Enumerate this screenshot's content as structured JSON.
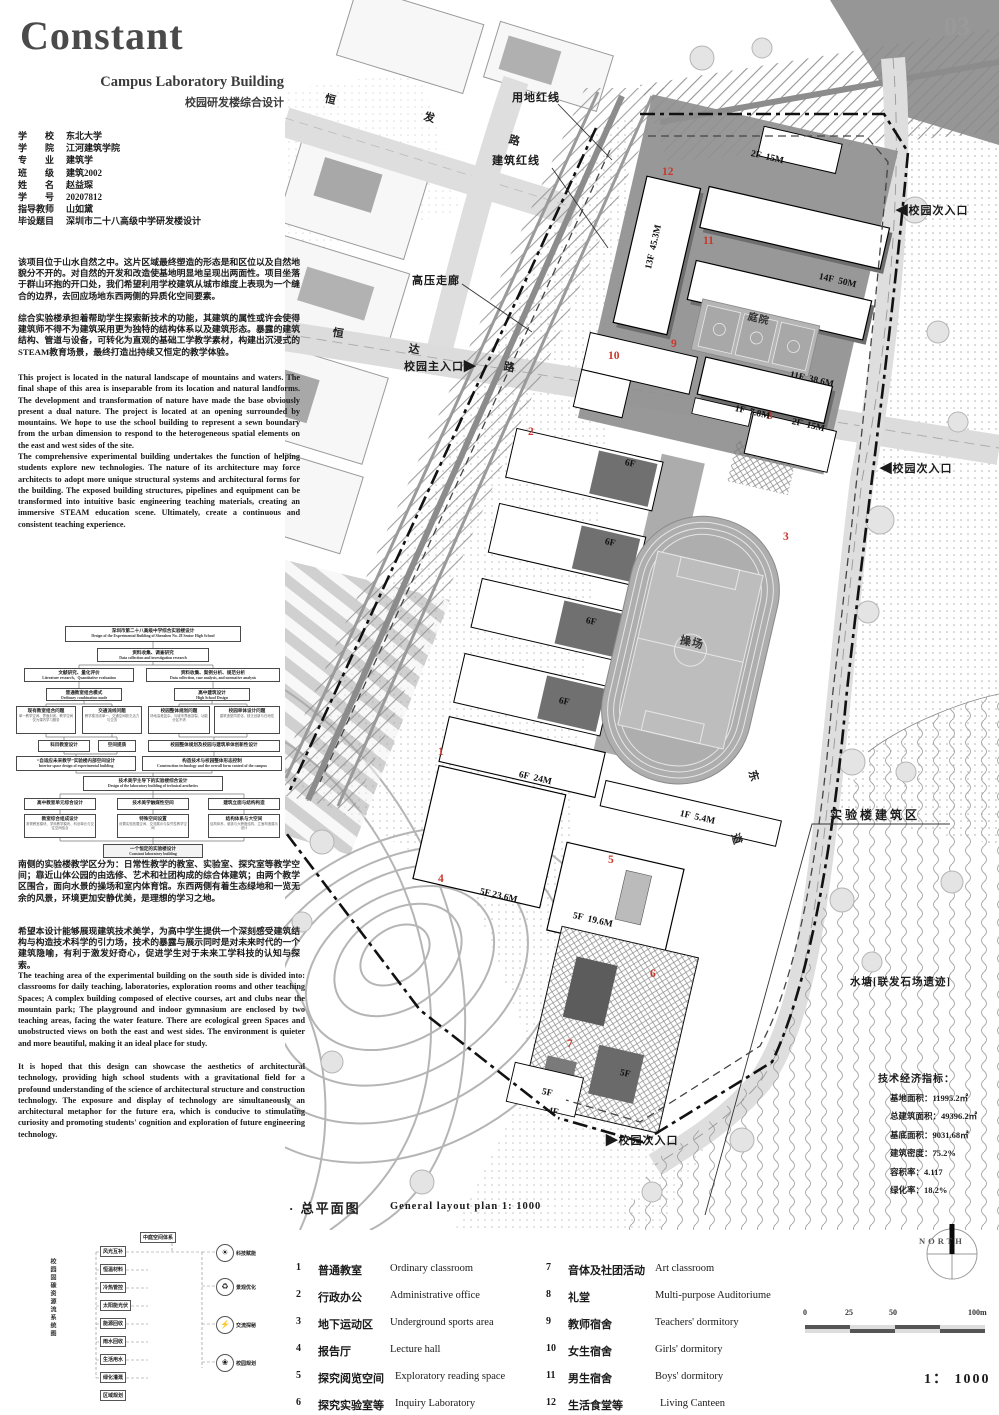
{
  "page": {
    "number": "03"
  },
  "header": {
    "title": "Constant",
    "subtitle_en": "Campus Laboratory Building",
    "subtitle_zh": "校园研发楼综合设计"
  },
  "info": {
    "rows": [
      {
        "label": "学　　校",
        "value": "东北大学"
      },
      {
        "label": "学　　院",
        "value": "江河建筑学院"
      },
      {
        "label": "专　　业",
        "value": "建筑学"
      },
      {
        "label": "班　　级",
        "value": "建筑2002"
      },
      {
        "label": "姓　　名",
        "value": "赵益琛"
      },
      {
        "label": "学　　号",
        "value": "20207812"
      },
      {
        "label": "指导教师",
        "value": "山如黛"
      },
      {
        "label": "毕设题目",
        "value": "深圳市二十八高级中学研发楼设计"
      }
    ]
  },
  "paras": {
    "zh1a": "该项目位于山水自然之中。这片区域最终塑造的形态是和区位以及自然地貌分不开的。对自然的开发和改造使基地明显地呈现出两面性。项目坐落于群山环抱的开口处，我们希望利用学校建筑从城市维度上表现为一个缝合的边界，去回应场地东西两侧的异质化空间要素。",
    "zh1b": "综合实验楼承担着帮助学生探索新技术的功能，其建筑的属性或许会使得建筑师不得不为建筑采用更为独特的结构体系以及建筑形态。暴露的建筑结构、管道与设备，可转化为直观的基础工学教学素材，构建出沉浸式的STEAM教育场景，最终打造出持续又恒定的教学体验。",
    "en1a": "This project is located in the natural landscape of mountains and waters. The final shape of this area is inseparable from its location and natural landforms. The development and transformation of nature have made the base obviously present a dual nature. The project is located at an opening surrounded by mountains. We hope to use the school building to represent a sewn boundary from the urban dimension to respond to the heterogeneous spatial elements on the east and west sides of the site.",
    "en1b": "The comprehensive experimental building undertakes the function of helping students explore new technologies. The nature of its architecture may force architects to adopt more unique structural systems and architectural forms for the building. The exposed building structures, pipelines and equipment can be transformed into intuitive basic engineering teaching materials, creating an immersive STEAM education scene. Ultimately, create a continuous and consistent teaching experience.",
    "zh2a": "南侧的实验楼教学区分为：日常性教学的教室、实验室、探究室等教学空间；靠近山体公园的由选修、艺术和社团构成的综合体建筑；由两个教学区围合，面向水景的操场和室内体育馆。东西两侧有着生态绿地和一览无余的风景，环境更加安静优美，是理想的学习之地。",
    "zh2b": "希望本设计能够展现建筑技术美学，为高中学生提供一个深刻感受建筑结构与构造技术科学的引力场，技术的暴露与展示同时是对未来时代的一个建筑隐喻，有利于激发好奇心，促进学生对于未来工学科技的认知与探索。",
    "en2a": "The teaching area of the experimental building on the south side is divided into: classrooms for daily teaching, laboratories, exploration rooms and other teaching Spaces; A complex building composed of elective courses, art and clubs near the mountain park; The playground and indoor gymnasium are enclosed by two teaching areas, facing the water feature. There are ecological green Spaces and unobstructed views on both the east and west sides. The environment is quieter and more beautiful, making it an ideal place for study.",
    "en2b": "It is hoped that this design can showcase the aesthetics of architectural technology, providing high school students with a gravitational field for a profound understanding of the science of architectural structure and construction technology. The exposure and display of technology are simultaneously an architectural metaphor for the future era, which is conducive to stimulating curiosity and promoting students' cognition and exploration of future engineering technology."
  },
  "flowchart": {
    "b0": {
      "zh": "深圳市第二十八高级中学综合实验楼设计",
      "en": "Design of the Experimental Building of Shenzhen No. 28 Senior High School"
    },
    "b1": {
      "zh": "资料收集、调查研究",
      "en": "Data collection and investigation research"
    },
    "b2l": {
      "zh": "文献研究、量化评价",
      "en": "Literature research、Quantitative evaluation"
    },
    "b2r": {
      "zh": "资料收集、案例分析、规范分析",
      "en": "Data collection, case analysis, and normative analysis"
    },
    "b3l": {
      "zh": "普通教室组合模式",
      "en": "Ordinary combination mode"
    },
    "b3r": {
      "zh": "高中建筑设计",
      "en": "High School Design"
    },
    "b4a": {
      "t": "现有教室组合问题",
      "s": "单一教学空间、界面封闭、教学空间仅为课内学习服务"
    },
    "b4b": {
      "t": "交通流线问题",
      "s": "教学楼流线单一、交通空间缺乏活力与交流"
    },
    "b4c": {
      "t": "校园整体规划问题",
      "s": "场地高差复杂、与城市界面割裂、功能分区不清"
    },
    "b4d": {
      "t": "校园单体设计问题",
      "s": "建筑造型同质化、缺乏创新与在地性"
    },
    "b5a": {
      "t": "科目教室设计"
    },
    "b5b": {
      "t": "空间提质"
    },
    "b5r": {
      "t": "校园整体规划及校园与建筑单体创新性设计"
    },
    "b6l": {
      "zh": "“自适应未来教学”实验楼内部空间设计",
      "en": "Interior space design of experimental building"
    },
    "b6r": {
      "zh": "构造技术与校园整体形态控制",
      "en": "Construction technology and the overall form control of the campus"
    },
    "b7": {
      "zh": "技术美学主导下的实验楼综合设计",
      "en": "Design of the laboratory building  of technical aesthetics"
    },
    "b8a": {
      "t": "高中教室单元综合设计"
    },
    "b8b": {
      "t": "技术美学触媒性空间"
    },
    "b8c": {
      "t": "建筑立面与结构构造"
    },
    "b9a": {
      "t": "教室综合组成设计",
      "s": "常规教室模块、学科教学模块、科创单元与交往空间结合"
    },
    "b9b": {
      "t": "特殊空间设置",
      "s": "设置实验拓展空间、交流展示与探究性教学空间"
    },
    "b9c": {
      "t": "结构体系与大空间",
      "s": "结构体系、悬挑与大跨度结构、立面构造展示设计"
    },
    "b10": {
      "zh": "一个恒定的实验楼设计",
      "en": "Constant  laboratory building"
    }
  },
  "sysdiag": {
    "side": "校园固碳资源流系统图",
    "boxes": [
      "中庭空间体系",
      "风光互补",
      "恒温材料",
      "冷热管控",
      "太阳能光伏",
      "能源回收",
      "雨水回收",
      "生活用水",
      "绿化灌溉",
      "区域规划"
    ],
    "circles": [
      {
        "icon": "☀",
        "label": "科技赋能"
      },
      {
        "icon": "♻",
        "label": "景观优化"
      },
      {
        "icon": "⚡",
        "label": "交流探秘"
      },
      {
        "icon": "❀",
        "label": "校园规划"
      }
    ]
  },
  "plan": {
    "annotations": {
      "site_line": "用地红线",
      "building_line": "建筑红线",
      "hv_corridor": "高压走廊",
      "lab_zone": "实验楼建筑区",
      "pond": "水塘[联发石场遗迹]",
      "playground": "操场",
      "courtyard": "庭院"
    },
    "entrances": {
      "main": "校园主入口",
      "sub": "校园次入口"
    },
    "roads": {
      "top1": "恒",
      "top2": "发",
      "top3": "路",
      "ew1": "恒",
      "ew2": "达",
      "ew3": "路",
      "e1": "东",
      "e2": "道"
    },
    "markers": [
      {
        "n": "1"
      },
      {
        "n": "2"
      },
      {
        "n": "3"
      },
      {
        "n": "4"
      },
      {
        "n": "5"
      },
      {
        "n": "6"
      },
      {
        "n": "7"
      },
      {
        "n": "8"
      },
      {
        "n": "9"
      },
      {
        "n": "10"
      },
      {
        "n": "11"
      },
      {
        "n": "12"
      }
    ],
    "floor_labels": [
      {
        "text": "2F  15M"
      },
      {
        "text": "13F  45.3M"
      },
      {
        "text": "14F  50M"
      },
      {
        "text": "11F  38.6M"
      },
      {
        "text": "1F  7.8M"
      },
      {
        "text": "2F  15M"
      },
      {
        "text": "6F"
      },
      {
        "text": "6F"
      },
      {
        "text": "6F"
      },
      {
        "text": "6F"
      },
      {
        "text": "6F  24M"
      },
      {
        "text": "1F  5.4M"
      },
      {
        "text": "5F 23.6M"
      },
      {
        "text": "5F  19.6M"
      },
      {
        "text": "5F"
      },
      {
        "text": "5F"
      },
      {
        "text": "4F"
      }
    ]
  },
  "section": {
    "zh": "· 总平面图",
    "en": "General layout plan   1:  1000"
  },
  "legend": {
    "items": [
      {
        "num": "1",
        "zh": "普通教室",
        "en": "Ordinary classroom"
      },
      {
        "num": "2",
        "zh": "行政办公",
        "en": "Administrative office"
      },
      {
        "num": "3",
        "zh": "地下运动区",
        "en": "Underground sports area"
      },
      {
        "num": "4",
        "zh": "报告厅",
        "en": "Lecture hall"
      },
      {
        "num": "5",
        "zh": "探究阅览空间",
        "en": "Exploratory reading space"
      },
      {
        "num": "6",
        "zh": "探究实验室等",
        "en": "Inquiry Laboratory"
      },
      {
        "num": "7",
        "zh": "音体及社团活动",
        "en": "Art classroom"
      },
      {
        "num": "8",
        "zh": "礼堂",
        "en": "Multi-purpose Auditoriume"
      },
      {
        "num": "9",
        "zh": "教师宿舍",
        "en": "Teachers' dormitory"
      },
      {
        "num": "10",
        "zh": "女生宿舍",
        "en": "Girls' dormitory"
      },
      {
        "num": "11",
        "zh": "男生宿舍",
        "en": "Boys' dormitory"
      },
      {
        "num": "12",
        "zh": "生活食堂等",
        "en": "Living Canteen"
      }
    ]
  },
  "indicators": {
    "title": "技术经济指标：",
    "rows": [
      {
        "label": "基地面积：",
        "value": "11995.2㎡"
      },
      {
        "label": "总建筑面积：",
        "value": "49396.2㎡"
      },
      {
        "label": "基底面积：",
        "value": "9031.68㎡"
      },
      {
        "label": "建筑密度：",
        "value": "75.2%"
      },
      {
        "label": "容积率：",
        "value": "4.117"
      },
      {
        "label": "绿化率：",
        "value": "18.2%"
      }
    ]
  },
  "scalebar": {
    "t0": "0",
    "t1": "25",
    "t2": "50",
    "t3": "100m"
  },
  "north": {
    "label": "NORTH"
  },
  "ratio": "1：  1000"
}
